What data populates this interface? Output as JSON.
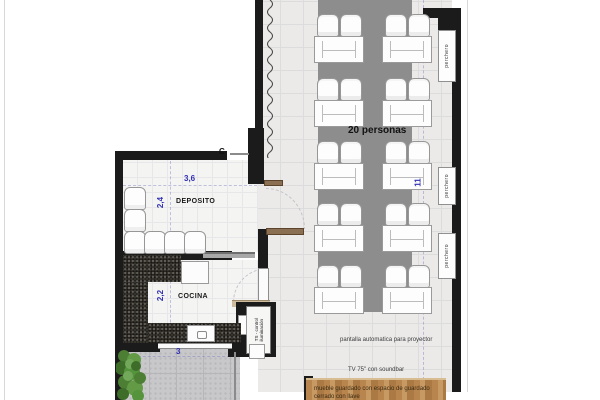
{
  "plan": {
    "capacity": "20 personas",
    "rooms": {
      "deposito": "DEPOSITO",
      "cocina": "COCINA"
    },
    "dims": {
      "deposito_width": "3,6",
      "deposito_depth": "2,4",
      "cocina_depth": "2,2",
      "terrace_width": "3",
      "dining_length": "11"
    },
    "labels": {
      "projector": "pantalla automatica para proyector",
      "tv": "TV 75\" con soundbar",
      "cabinet_line1": "mueble guardado con espacio de guardado",
      "cabinet_line2": "cerrado con llave",
      "lighting_line1": "TS - control",
      "lighting_line2": "iluminación",
      "perchero": "perchero",
      "marker_c": "C"
    },
    "furniture": {
      "dining_table_rows": 5,
      "dining_table_cols": 2,
      "chairs_per_table": 2,
      "coat_racks": 3,
      "stored_chairs": 6
    },
    "colors": {
      "wall": "#1b1b1b",
      "rug": "#8d8d8d",
      "dim_blue": "#2f2fb4",
      "wood": "#b5854f",
      "counter_dark": "#36322c",
      "plant_green": "#4c7f33"
    }
  }
}
